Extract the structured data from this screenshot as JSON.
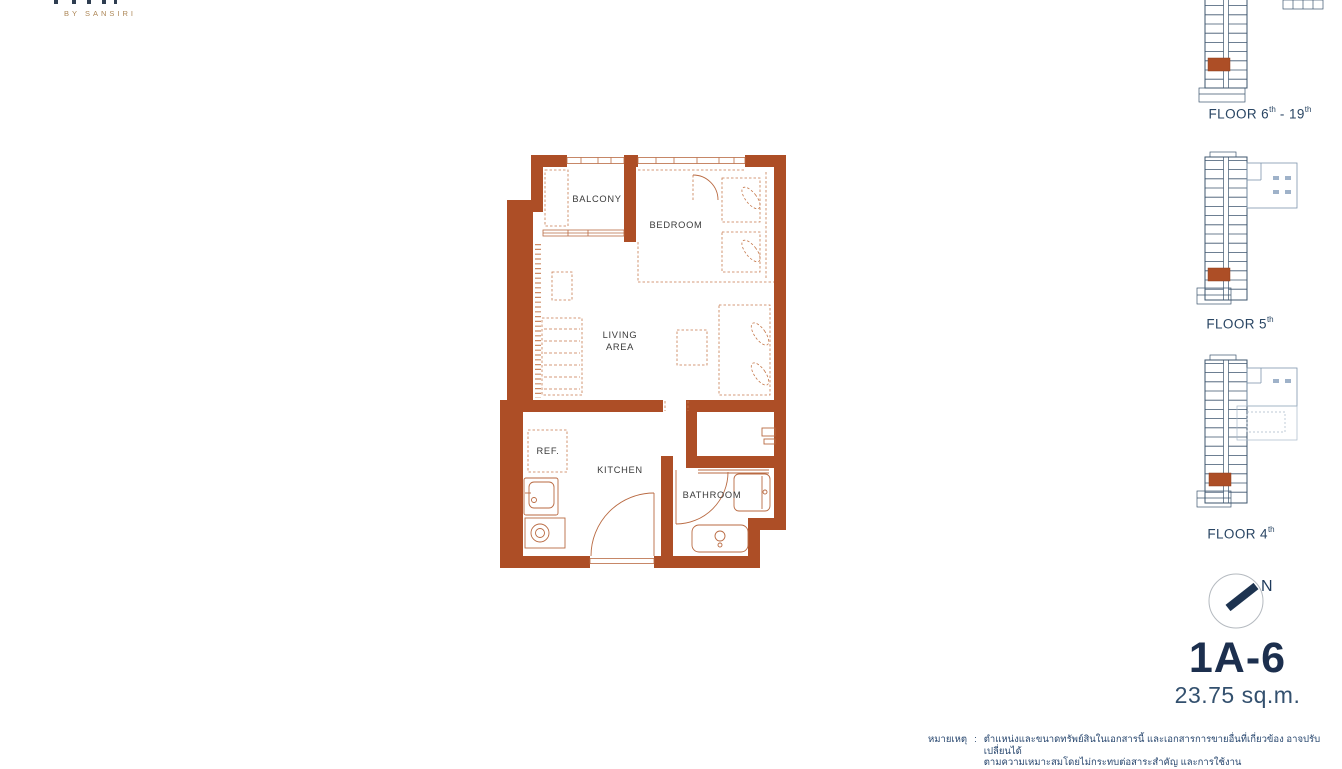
{
  "brand": {
    "byline": "BY SANSIRI"
  },
  "floorplan": {
    "labels": {
      "balcony": "BALCONY",
      "bedroom": "BEDROOM",
      "living_line1": "LIVING",
      "living_line2": "AREA",
      "ref": "REF.",
      "kitchen": "KITCHEN",
      "bathroom": "BATHROOM"
    }
  },
  "keyplans": [
    {
      "name": "floor-6-19",
      "text": "FLOOR 6",
      "sup1": "th",
      "mid": " - 19",
      "sup2": "th"
    },
    {
      "name": "floor-5",
      "text": "FLOOR 5",
      "sup1": "th",
      "mid": "",
      "sup2": ""
    },
    {
      "name": "floor-4",
      "text": "FLOOR 4",
      "sup1": "th",
      "mid": "",
      "sup2": ""
    }
  ],
  "compass": {
    "north_label": "N"
  },
  "unit": {
    "name": "1A-6",
    "area": "23.75 sq.m."
  },
  "note": {
    "label": "หมายเหตุ",
    "separator": ":",
    "line1": "ตำแหน่งและขนาดทรัพย์สินในเอกสารนี้ และเอกสารการขายอื่นที่เกี่ยวข้อง อาจปรับเปลี่ยนได้",
    "line2": "ตามความเหมาะสมโดยไม่กระทบต่อสาระสำคัญ และการใช้งาน"
  },
  "colors": {
    "wall": "#ad4e26",
    "furniture": "#c67a4e",
    "navy": "#1d3b5e",
    "gold": "#ad8757"
  }
}
